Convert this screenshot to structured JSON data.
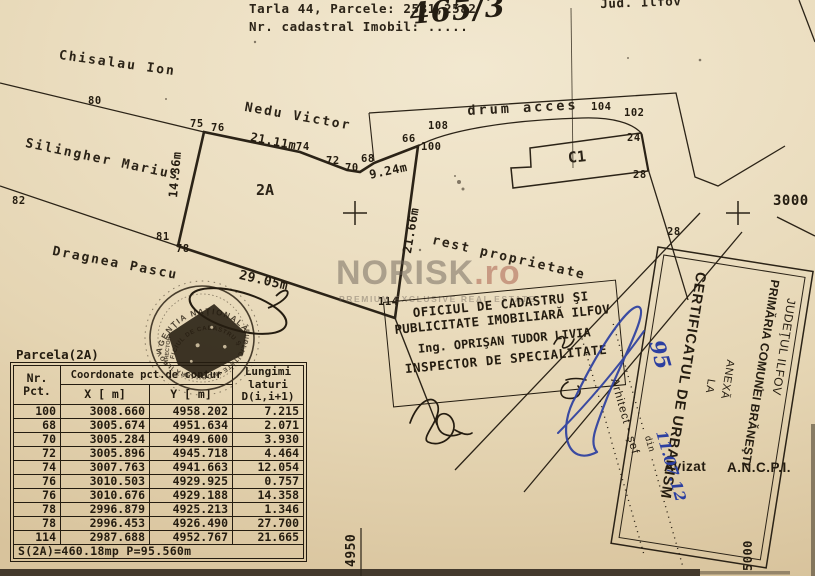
{
  "colors": {
    "paper": "#ecdfc2",
    "ink": "#2b2317",
    "blue_ink": "#2c3fa0",
    "watermark_gray": "#6c6258",
    "watermark_red": "#9e4838"
  },
  "header": {
    "parcel_line": "Tarla 44, Parcele: 2581,2582",
    "cadastral_line": "Nr. cadastral Imobil: .....",
    "cadastral_number_handwritten": "465/3",
    "county": "Jud. Ilfov"
  },
  "map": {
    "owners": {
      "north": "Chisalau Ion",
      "northeast": "Nedu Victor",
      "west": "Silingher Marius",
      "south": "Dragnea Pascu"
    },
    "road_label": "drum acces",
    "rest_label": "rest proprietate",
    "building_label": "C1",
    "parcel_label": "2A",
    "point_labels": [
      {
        "t": "80",
        "x": 88,
        "y": 95
      },
      {
        "t": "75",
        "x": 190,
        "y": 118
      },
      {
        "t": "76",
        "x": 211,
        "y": 122
      },
      {
        "t": "74",
        "x": 296,
        "y": 141
      },
      {
        "t": "72",
        "x": 326,
        "y": 155
      },
      {
        "t": "70",
        "x": 345,
        "y": 162
      },
      {
        "t": "68",
        "x": 361,
        "y": 153
      },
      {
        "t": "66",
        "x": 402,
        "y": 133
      },
      {
        "t": "100",
        "x": 421,
        "y": 141
      },
      {
        "t": "108",
        "x": 428,
        "y": 120
      },
      {
        "t": "104",
        "x": 591,
        "y": 101
      },
      {
        "t": "102",
        "x": 624,
        "y": 107
      },
      {
        "t": "24",
        "x": 627,
        "y": 132
      },
      {
        "t": "28",
        "x": 633,
        "y": 169
      },
      {
        "t": "28",
        "x": 667,
        "y": 226
      },
      {
        "t": "82",
        "x": 12,
        "y": 195
      },
      {
        "t": "81",
        "x": 156,
        "y": 231
      },
      {
        "t": "78",
        "x": 176,
        "y": 243
      },
      {
        "t": "114",
        "x": 378,
        "y": 296
      },
      {
        "t": "3000",
        "x": 773,
        "y": 193,
        "s": 14
      },
      {
        "t": "21.11m",
        "x": 252,
        "y": 130,
        "r": 11,
        "s": 12
      },
      {
        "t": "9.24m",
        "x": 368,
        "y": 168,
        "r": -12,
        "s": 12
      },
      {
        "t": "14.36m",
        "x": 166,
        "y": 197,
        "r": -85,
        "s": 12
      },
      {
        "t": "21.66m",
        "x": 400,
        "y": 252,
        "r": -80,
        "s": 12
      },
      {
        "t": "29.05m",
        "x": 241,
        "y": 268,
        "r": 13,
        "s": 13
      },
      {
        "t": "4950",
        "x": 344,
        "y": 567,
        "r": -90,
        "s": 13
      },
      {
        "t": "5000",
        "x": 741,
        "y": 571,
        "r": -90,
        "s": 12
      }
    ]
  },
  "watermark": {
    "name": "NORISK",
    "tld": ".ro",
    "tagline": "PREMIUM EXCLUSIVE REAL ESTATE"
  },
  "cadastre_office_box": {
    "line1": "OFICIUL DE CADASTRU ŞI",
    "line2": "PUBLICITATE IMOBILIARĂ ILFOV",
    "line3": "Ing. OPRIŞAN TUDOR LIVIA",
    "line4": "INSPECTOR DE SPECIALITATE"
  },
  "certificate_box": {
    "line1": "JUDEŢUL ILFOV",
    "line2": "PRIMĂRIA COMUNEI BRĂNEŞTI",
    "line3": "ANEXĂ",
    "line4": "LA",
    "line5": "CERTIFICATUL DE URBANISM",
    "avizat": "Avizat",
    "ancpi": "A.N.C.P.I."
  },
  "signature_block": {
    "dotted_din": "..................... din .....................",
    "role": "Arhitect - şef",
    "dotted": "...........................................",
    "number_handwritten": "95",
    "date_handwritten": "11.07.12"
  },
  "stamp": {
    "arc_top": "AGENŢIA NAŢIONALĂ",
    "arc_mid": "OFICIUL DE CADASTRU ŞI",
    "arc_bottom": "PUBLICITATE IMOBILIARĂ ILFOV",
    "side": "DIRECTOR"
  },
  "table": {
    "title": "Parcela(2A)",
    "col_nr": "Nr. Pct.",
    "col_coord": "Coordonate pct.de contur",
    "col_x": "X [ m]",
    "col_y": "Y [ m]",
    "col_d": "Lungimi laturi D(i,i+1)",
    "rows": [
      [
        "100",
        "3008.660",
        "4958.202",
        "7.215"
      ],
      [
        "68",
        "3005.674",
        "4951.634",
        "2.071"
      ],
      [
        "70",
        "3005.284",
        "4949.600",
        "3.930"
      ],
      [
        "72",
        "3005.896",
        "4945.718",
        "4.464"
      ],
      [
        "74",
        "3007.763",
        "4941.663",
        "12.054"
      ],
      [
        "76",
        "3010.503",
        "4929.925",
        "0.757"
      ],
      [
        "76",
        "3010.676",
        "4929.188",
        "14.358"
      ],
      [
        "78",
        "2996.879",
        "4925.213",
        "1.346"
      ],
      [
        "78",
        "2996.453",
        "4926.490",
        "27.700"
      ],
      [
        "114",
        "2987.688",
        "4952.767",
        "21.665"
      ]
    ],
    "footer": "S(2A)=460.18mp  P=95.560m"
  }
}
